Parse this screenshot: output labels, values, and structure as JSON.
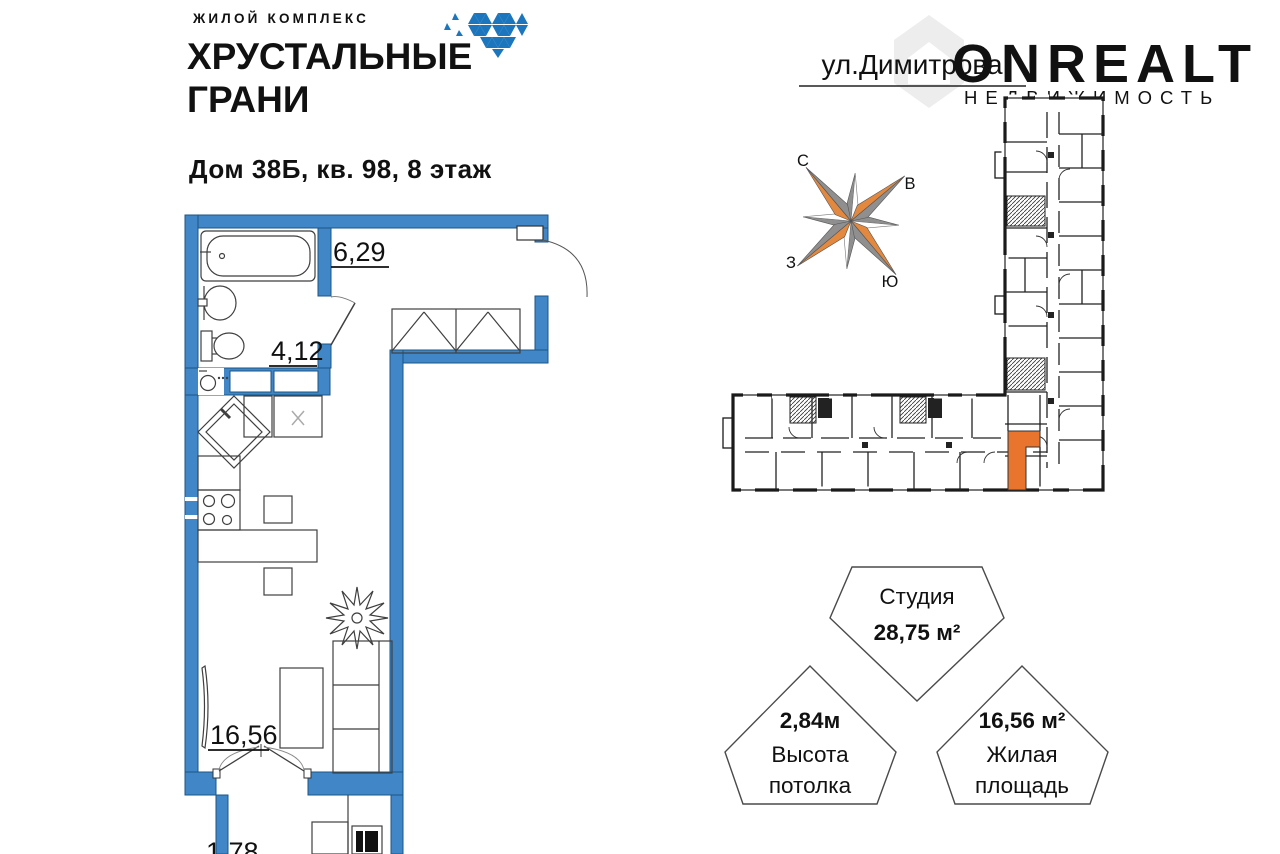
{
  "logo": {
    "eyebrow": "ЖИЛОЙ КОМПЛЕКС",
    "line1": "ХРУСТАЛЬНЫЕ",
    "line2": "ГРАНИ",
    "brand_color": "#1b76bd",
    "eyebrow_color": "#5b9ccc"
  },
  "listing": {
    "title": "Дом 38Б, кв. 98, 8 этаж"
  },
  "street": {
    "label": "ул.Димитрова"
  },
  "compass": {
    "north": "С",
    "east": "В",
    "west": "З",
    "south": "Ю",
    "orange": "#e2883f",
    "gray": "#8f8f8f"
  },
  "unit_plan": {
    "wall_color": "#4187c7",
    "labels": {
      "hall": "6,29",
      "bathroom": "4,12",
      "living": "16,56",
      "balcony": "1,78"
    }
  },
  "building_plan": {
    "highlight_color": "#e8742e",
    "outline_color": "#1a1a1a"
  },
  "badges": {
    "type": {
      "label": "Студия",
      "value": "28,75 м²"
    },
    "ceiling": {
      "value": "2,84м",
      "caption_line1": "Высота",
      "caption_line2": "потолка"
    },
    "living": {
      "value": "16,56 м²",
      "caption_line1": "Жилая",
      "caption_line2": "площадь"
    }
  },
  "watermark": {
    "brand": "ONREALT",
    "caption": "НЕДВИЖИМОСТЬ"
  }
}
